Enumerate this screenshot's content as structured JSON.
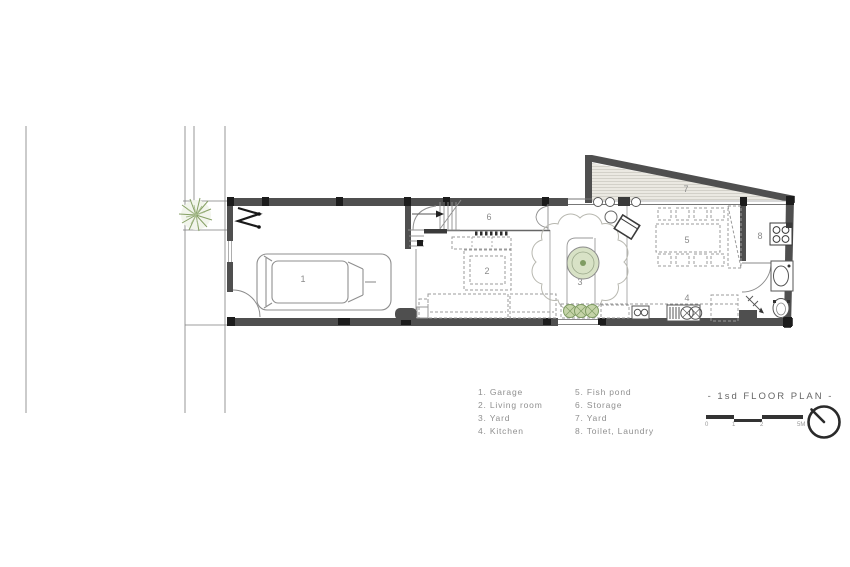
{
  "plan": {
    "room_numbers": [
      "1",
      "2",
      "3",
      "4",
      "5",
      "6",
      "7",
      "8"
    ]
  },
  "legend": {
    "col1": [
      "1. Garage",
      "2. Living room",
      "3. Yard",
      "4. Kitchen"
    ],
    "col2": [
      "5. Fish pond",
      "6. Storage",
      "7. Yard",
      "8. Toilet, Laundry"
    ]
  },
  "title_block": {
    "title": "- 1sd FLOOR PLAN -",
    "scale_ticks": [
      "0",
      "1",
      "2",
      "5M"
    ]
  },
  "colors": {
    "wall": "#4f4f4f",
    "green": "#7f9c63"
  }
}
